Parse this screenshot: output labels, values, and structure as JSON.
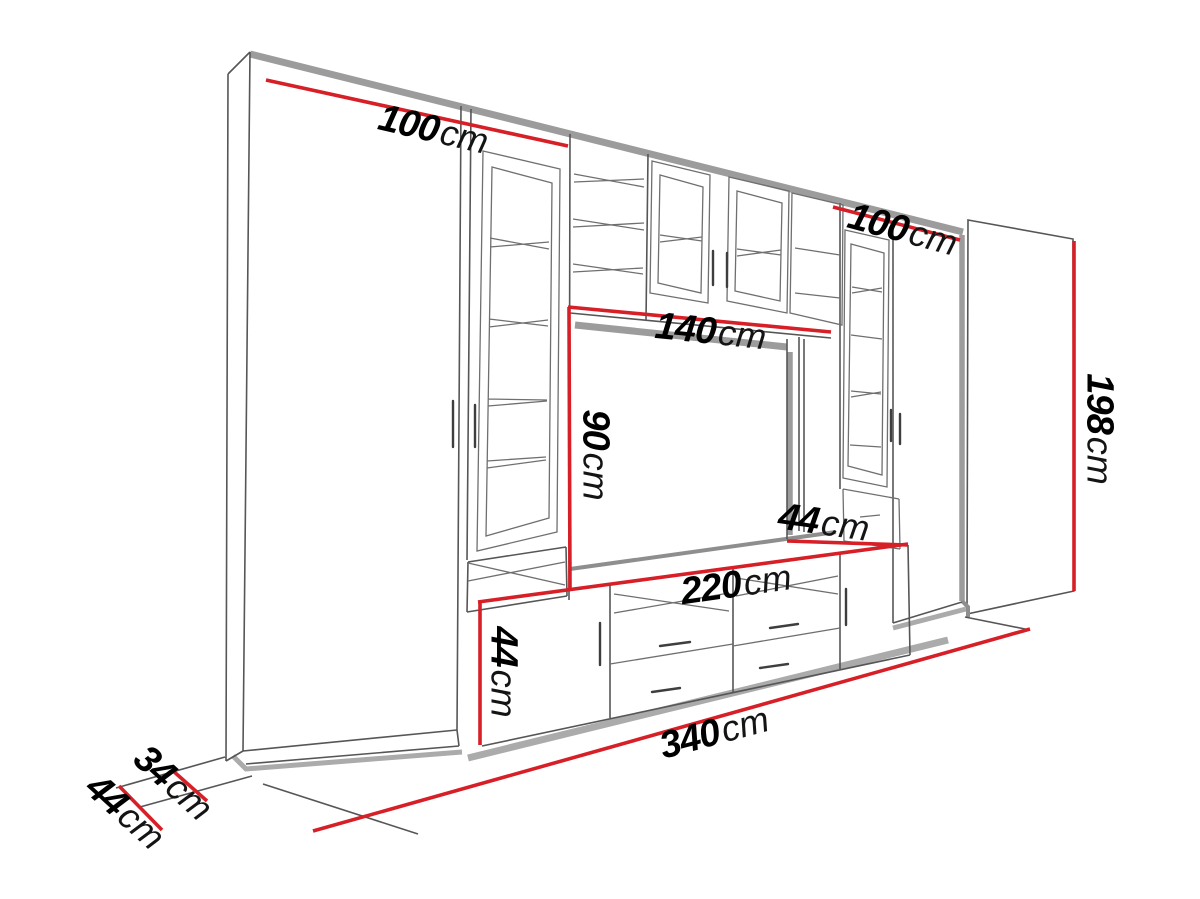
{
  "page": {
    "background_color": "#ffffff"
  },
  "diagram": {
    "kind": "furniture-dimension-drawing",
    "subject": "TV wall unit perspective drawing with dimensions",
    "accent_color": "#d61f26",
    "frame_color": "#9c9c9c",
    "line_color": "#565656",
    "text_color": "#000000",
    "dimensions": [
      {
        "name": "left-upper-cabinet-width",
        "value": "100",
        "unit": "cm"
      },
      {
        "name": "right-upper-cabinet-width",
        "value": "100",
        "unit": "cm"
      },
      {
        "name": "tv-niche-width",
        "value": "140",
        "unit": "cm"
      },
      {
        "name": "tv-niche-height",
        "value": "90",
        "unit": "cm"
      },
      {
        "name": "lower-cabinet-depth",
        "value": "44",
        "unit": "cm"
      },
      {
        "name": "tv-stand-width",
        "value": "220",
        "unit": "cm"
      },
      {
        "name": "tv-stand-height",
        "value": "44",
        "unit": "cm"
      },
      {
        "name": "total-width",
        "value": "340",
        "unit": "cm"
      },
      {
        "name": "upper-section-depth",
        "value": "34",
        "unit": "cm"
      },
      {
        "name": "base-depth",
        "value": "44",
        "unit": "cm"
      },
      {
        "name": "total-height",
        "value": "198",
        "unit": "cm"
      }
    ]
  }
}
